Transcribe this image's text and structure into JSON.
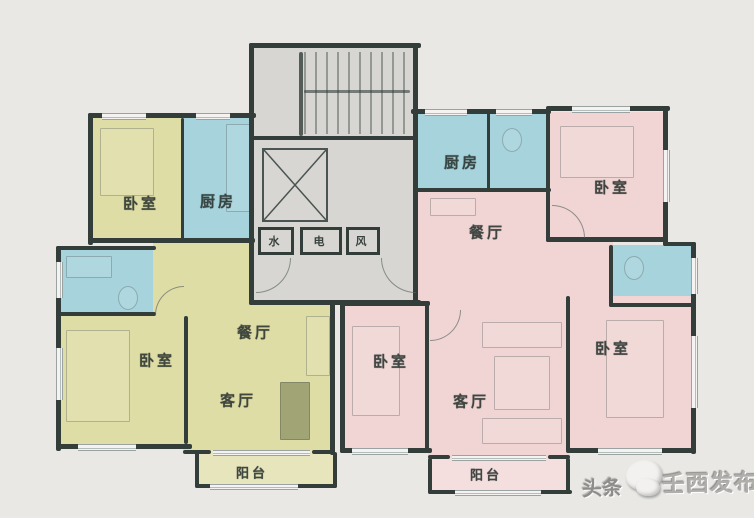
{
  "title": "residential-floor-plan",
  "colors": {
    "background": "#e9e8e5",
    "wall": "#333d3a",
    "room_yellow": "#dfdda6",
    "room_blue": "#a6d3dc",
    "room_pink": "#f0d5d4",
    "core_gray": "#d8d6d2",
    "balcony_yellow": "#e7e5bc",
    "balcony_pink": "#f4dfde",
    "label_text": "#28322f",
    "window_fill": "#f4f3f1",
    "watermark_text": "#b0aeab",
    "watermark_brand": "#8f8d8a"
  },
  "left_unit": {
    "bedroom_top": "卧室",
    "kitchen": "厨房",
    "bedroom_main": "卧室",
    "dining": "餐厅",
    "living": "客厅",
    "balcony": "阳台"
  },
  "right_unit": {
    "kitchen": "厨房",
    "bedroom_top": "卧室",
    "dining": "餐厅",
    "bedroom_middle": "卧室",
    "living": "客厅",
    "bedroom_right": "卧室",
    "balcony": "阳台"
  },
  "core": {
    "water_shaft": "水",
    "electric_shaft": "电",
    "vent_shaft": "风"
  },
  "watermark": {
    "brand": "头条",
    "publisher": "壬西发布"
  }
}
